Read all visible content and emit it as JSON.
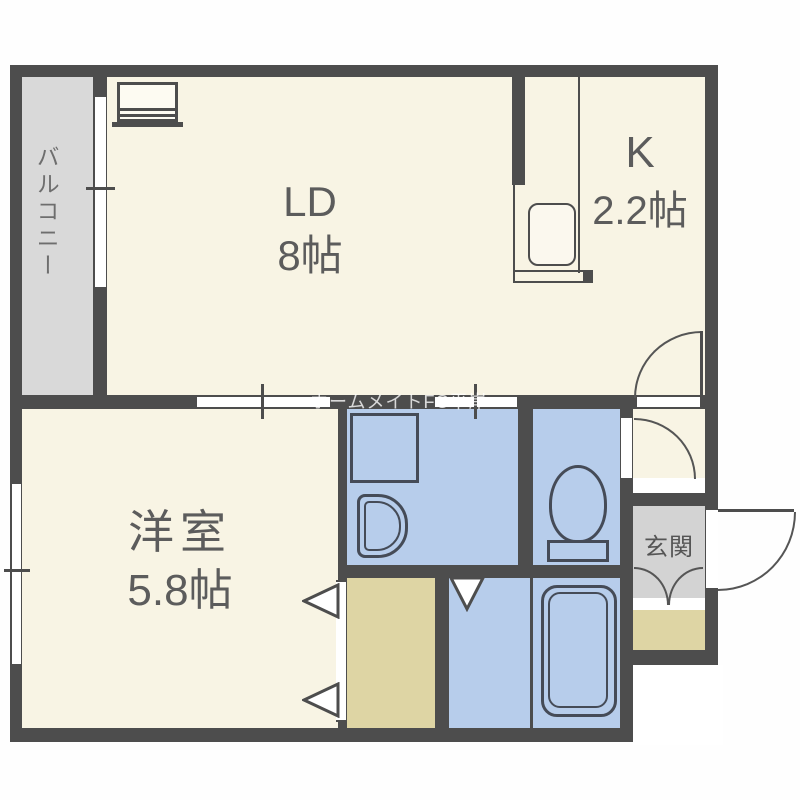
{
  "watermark": "ホームメイトFC平岸",
  "rooms": {
    "balcony": {
      "label": "バルコニー"
    },
    "living_dining": {
      "label": "LD",
      "size": "8帖"
    },
    "kitchen": {
      "label": "K",
      "size": "2.2帖"
    },
    "western_room": {
      "label": "洋室",
      "size": "5.8帖"
    },
    "entrance": {
      "label": "玄関"
    }
  },
  "icons": [
    "stove-icon",
    "kitchen-sink-icon",
    "washing-machine-icon",
    "washbasin-icon",
    "toilet-icon",
    "bathtub-icon",
    "door-swing-arc-icon",
    "folding-door-triangle-icon",
    "sliding-window-icon"
  ],
  "colors": {
    "wall": "#4d4d4d",
    "floor_cream": "#f8f4e4",
    "wet_area_blue": "#b7cdeb",
    "balcony_gray": "#d9d9d9",
    "entrance_gray": "#d3d3d3",
    "storage_tan": "#ded5a4",
    "fixture_line": "#4d4d4d",
    "label_text": "#5c5c5c",
    "watermark_text": "rgba(255,255,255,0.78)"
  }
}
